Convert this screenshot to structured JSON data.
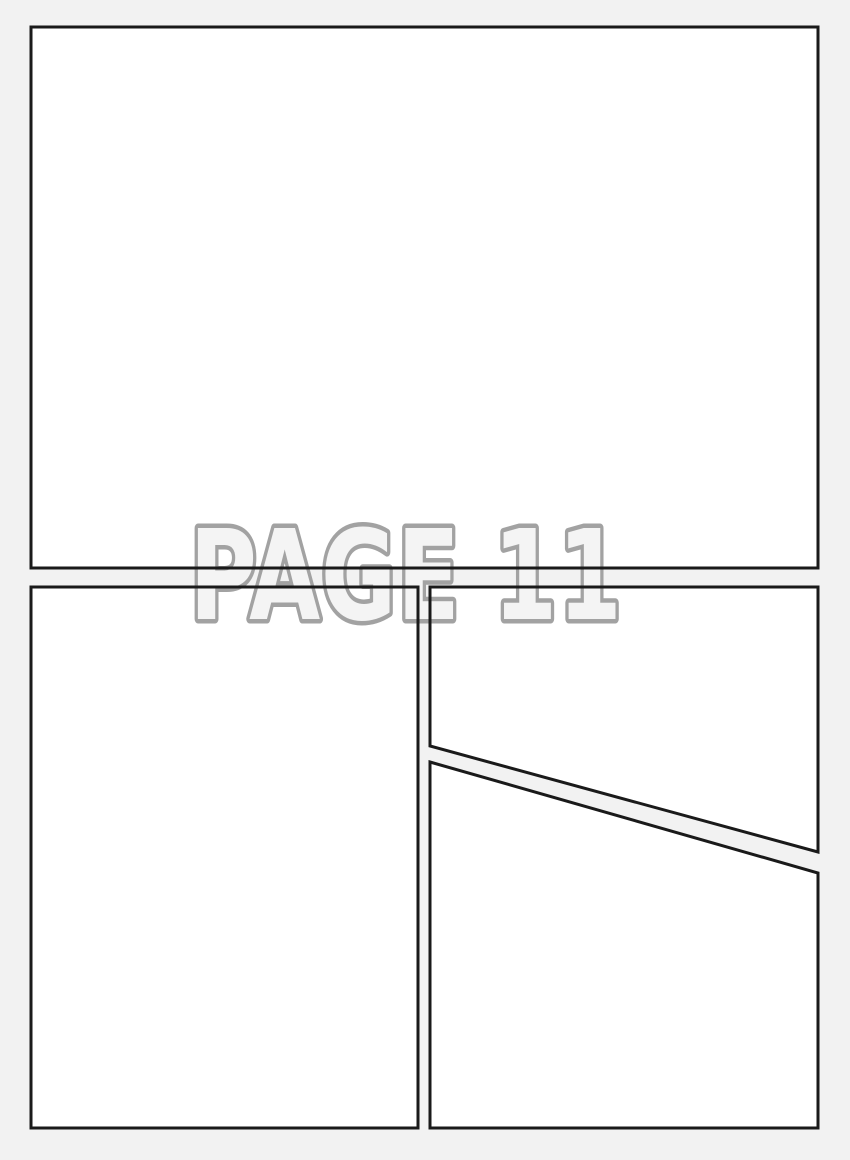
{
  "watermark": {
    "text": "PAGE 11"
  },
  "panels": {
    "count": 4,
    "description_labels": [
      "panel-1",
      "panel-2",
      "panel-3",
      "panel-4"
    ]
  },
  "colors": {
    "page_background": "#f2f2f2",
    "panel_fill": "#ffffff",
    "panel_border": "#1a1a1a",
    "watermark_fill": "#f4f4f4",
    "watermark_outline": "#a2a2a2"
  }
}
